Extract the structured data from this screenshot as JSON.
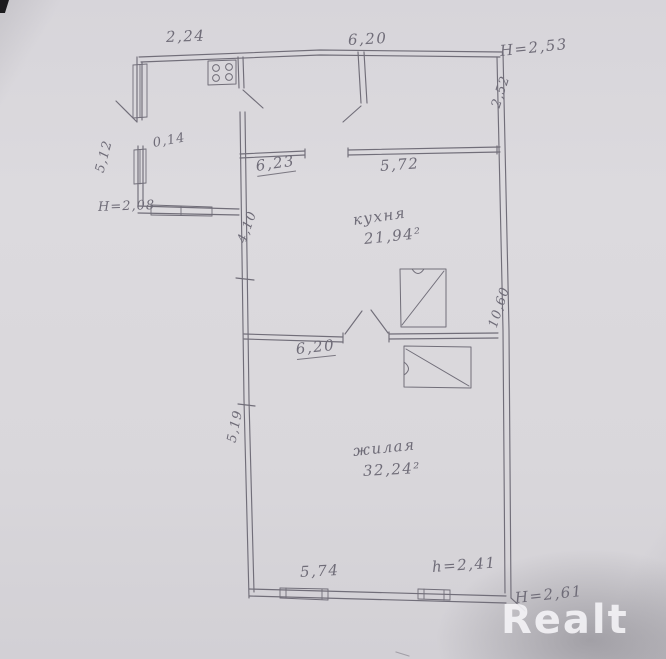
{
  "scan": {
    "paper_color": "#d9d7db",
    "pencil_color": "#6e6b75",
    "description": "Scanned hand-drawn floor plan (BTI style) with Cyrillic room labels"
  },
  "watermark": {
    "text": "Realt"
  },
  "plan": {
    "rooms": {
      "kitchen": {
        "name": "кухня",
        "area": "21,94²"
      },
      "living": {
        "name": "жилая",
        "area": "32,24²"
      }
    },
    "dims": {
      "annex_width": "2,24",
      "top_width": "6,20",
      "top_height": "Н=2,53",
      "right_room_depth": "2,52",
      "annex_offset": "0,14",
      "annex_side": "5,12",
      "annex_height": "Н=2,08",
      "hall_wall": "6,23",
      "kitchen_top_width": "5,72",
      "kitchen_left_depth": "4,10",
      "partition_length": "6,20",
      "right_side_total": "10,60",
      "living_left_depth": "5,19",
      "bottom_width": "5,74",
      "living_height": "h=2,41",
      "bottom_height": "Н=2,61"
    }
  }
}
